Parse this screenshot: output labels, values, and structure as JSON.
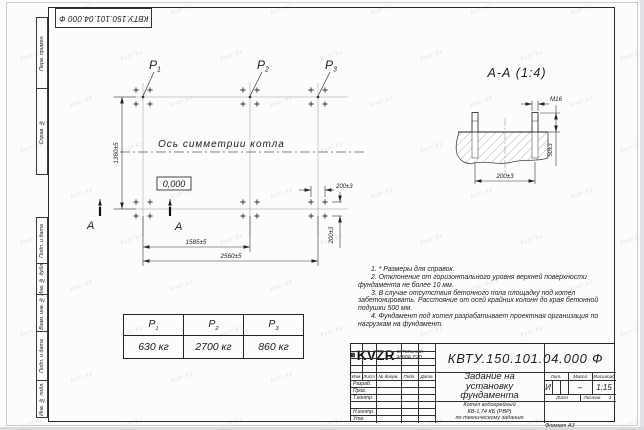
{
  "sheet": {
    "format_note": "Формат А3"
  },
  "watermark": {
    "text": "kvzr.kz"
  },
  "frame_columns": {
    "top_doc_number": "КВТУ.150.101.04.000 Ф",
    "cells_top": [
      "Перв. примен.",
      "Справ. №"
    ],
    "cells_bottom": [
      "Подп. и дата",
      "Инв. № дубл.",
      "Взам. инв. №",
      "Подп. и дата",
      "Инв. № подл."
    ]
  },
  "plan": {
    "points": [
      {
        "name": "P",
        "sub": "1"
      },
      {
        "name": "P",
        "sub": "2"
      },
      {
        "name": "P",
        "sub": "3"
      }
    ],
    "axis_label": "Ось симметрии котла",
    "elevation_mark": "0,000",
    "dims": {
      "height": "1360±5",
      "span_p1_p2": "1585±5",
      "span_p1_p3": "2560±5",
      "bolt_group_h": "200±3",
      "bolt_group_v": "200±3"
    },
    "section_letter": "А"
  },
  "section_view": {
    "title": "А-А (1:4)",
    "thread_label": "М16",
    "dims": {
      "protrusion": "50±3",
      "bolt_spacing": "200±3"
    }
  },
  "load_table": {
    "columns": [
      {
        "name": "P",
        "sub": "1"
      },
      {
        "name": "P",
        "sub": "2"
      },
      {
        "name": "P",
        "sub": "3"
      }
    ],
    "values": [
      "630 кг",
      "2700 кг",
      "860 кг"
    ]
  },
  "notes": [
    "1. * Размеры для справок.",
    "2. Отклонение от горизонтального уровня верхней поверхности фундамента не более 10 мм.",
    "3. В случае отсутствия бетонного пола площадку под котел забетонировать. Расстояние от осей крайних колонн до края бетонной подушки 500 мм.",
    "4. Фундамент под котел разрабатывает проектная организация по нагрузкам на фундамент."
  ],
  "title_block": {
    "doc_number": "КВТУ.150.101.04.000 Ф",
    "title_lines": [
      "Задание на",
      "установку",
      "фундамента"
    ],
    "header": {
      "izm": "Изм.",
      "list": "Лист",
      "dokum": "№ докум.",
      "podp": "Подп.",
      "data": "Дата"
    },
    "rows": [
      "Разраб.",
      "Пров.",
      "Т.контр.",
      "",
      "Н.контр.",
      "Утв."
    ],
    "lit_label": "Лит.",
    "mass_label": "Масса",
    "scale_label": "Масштаб",
    "lit_value": "И",
    "mass_value": "–",
    "scale_value": "1:15",
    "sheet_label": "Лист",
    "sheets_label": "Листов",
    "sheets_value": "1",
    "product_lines": [
      "Котел водогрейный",
      "КВ-1,74 КБ (РВР)",
      "по техническому заданию"
    ],
    "logo_text": "KVZR",
    "company_lines": [
      "КОТЕЛЬНЫЙ",
      "ЗАВОД, РЭП"
    ]
  }
}
